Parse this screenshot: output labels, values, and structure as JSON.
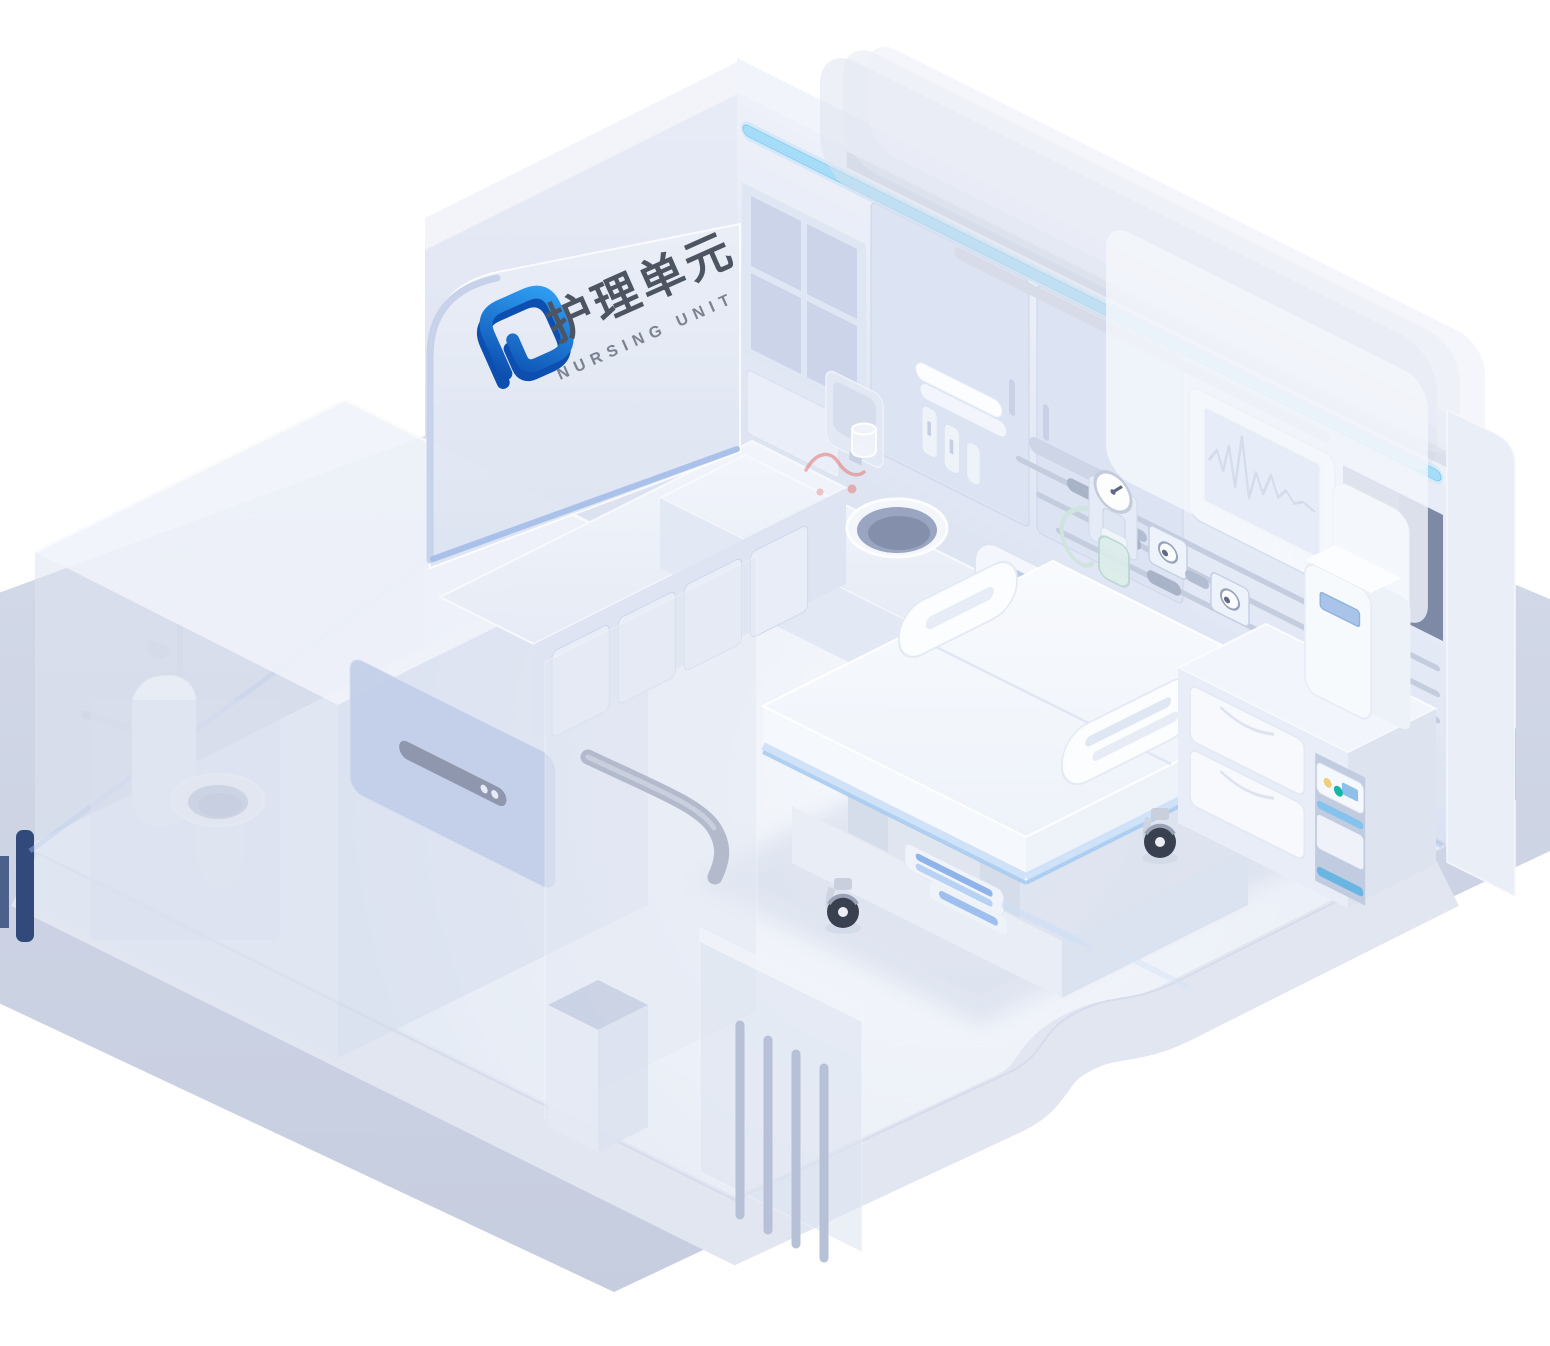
{
  "sign": {
    "title_zh": "护理单元",
    "title_en": "NURSING UNIT"
  },
  "colors": {
    "brand-dark": "#0d4fb0",
    "brand-light": "#2f9ff3",
    "text-dark": "#4d5462",
    "text-mid": "#7b8290",
    "led": "#a5ddf8",
    "accent": "#9db9e9",
    "navy": "#32497b",
    "screen": "#b6c7e9",
    "wave": "#5d78b6",
    "headboard": "#b9cfe9",
    "bed-stripe": "#a9ccf1",
    "teal": "#17b7a6",
    "yellow": "#eecf7d",
    "cable": "#e4756d",
    "wheel": "#39404f"
  },
  "objects": [
    "nursing-unit-sign",
    "logo-mark",
    "back-wall",
    "led-strip",
    "wall-shelf",
    "wall-cabinet-doors",
    "patient-monitor",
    "ecg-screen",
    "equipment-recess",
    "supply-rails",
    "gas-outlet",
    "oxygen-flowmeter",
    "humidifier-bottle",
    "counter",
    "sink-basin",
    "water-dispenser",
    "water-cup",
    "towels",
    "dispenser-bottles",
    "nurse-call-cable",
    "hospital-bed",
    "headboard",
    "bed-rail",
    "bed-caster",
    "foot-control",
    "bedside-cabinet",
    "drawer",
    "bedside-device",
    "cabinet-appliance",
    "bathroom",
    "toilet",
    "shower",
    "grab-bar",
    "tv-panel",
    "trash-bin",
    "vent-grille",
    "curtain-rail",
    "ghost-wall",
    "room-platform",
    "ground-platform"
  ]
}
